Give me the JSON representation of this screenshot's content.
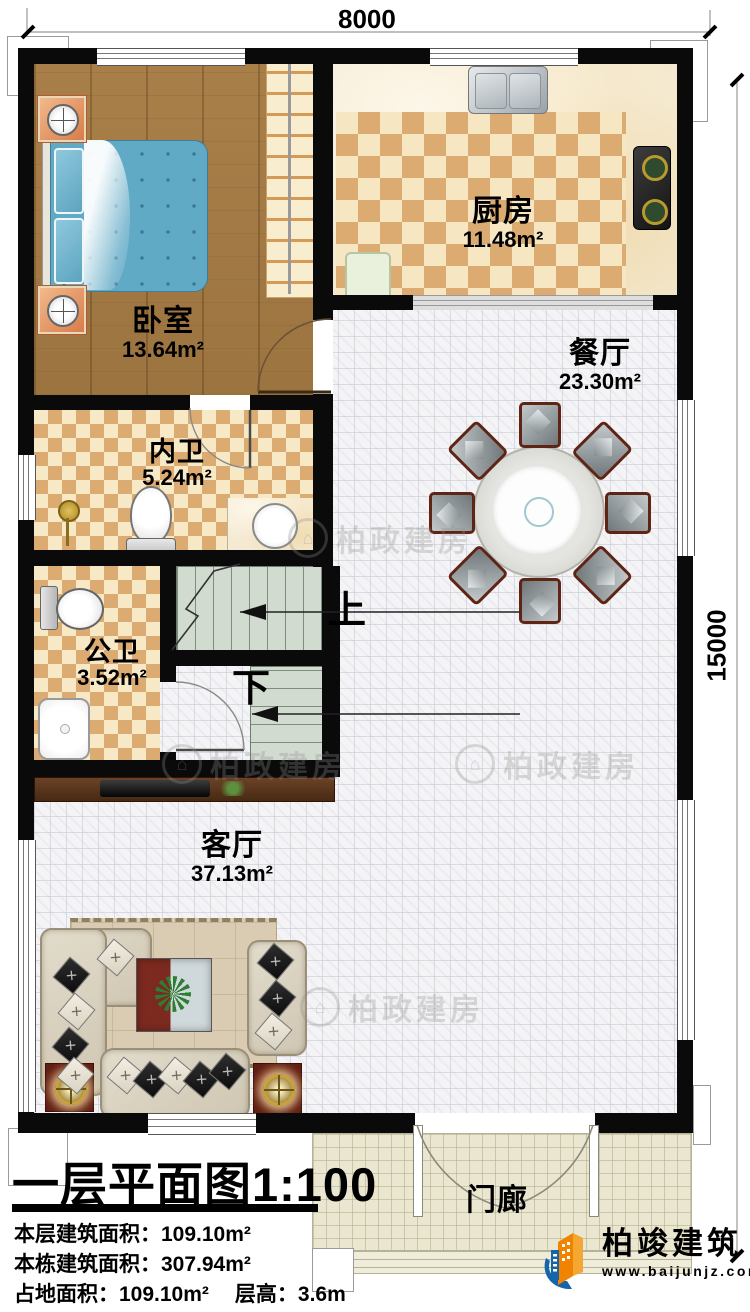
{
  "dimensions": {
    "width_label": "8000",
    "height_label": "15000"
  },
  "rooms": {
    "bedroom": {
      "name": "卧室",
      "area": "13.64m²"
    },
    "kitchen": {
      "name": "厨房",
      "area": "11.48m²"
    },
    "ensuite": {
      "name": "内卫",
      "area": "5.24m²"
    },
    "public_bath": {
      "name": "公卫",
      "area": "3.52m²"
    },
    "dining": {
      "name": "餐厅",
      "area": "23.30m²"
    },
    "living": {
      "name": "客厅",
      "area": "37.13m²"
    },
    "porch": {
      "name": "门廊"
    }
  },
  "stairs": {
    "up": "上",
    "down": "下"
  },
  "title_block": {
    "title": "一层平面图",
    "scale": "1:100",
    "floor_area_label": "本层建筑面积：",
    "floor_area_value": "109.10m²",
    "total_area_label": "本栋建筑面积：",
    "total_area_value": "307.94m²",
    "land_area_label": "占地面积：",
    "land_area_value": "109.10m²",
    "story_height_label": "层高：",
    "story_height_value": "3.6m"
  },
  "branding": {
    "company": "柏竣建筑",
    "website": "www.baijunjz.com"
  },
  "watermark": {
    "text": "柏政建房"
  },
  "colors": {
    "wall": "#0a0a0a",
    "tile_dark": "#dcab72",
    "tile_light": "#f6e6c2",
    "wood": "#a67c47",
    "stair": "#d2dbd0",
    "logo_blue": "#1565ab",
    "logo_orange": "#f08300"
  }
}
